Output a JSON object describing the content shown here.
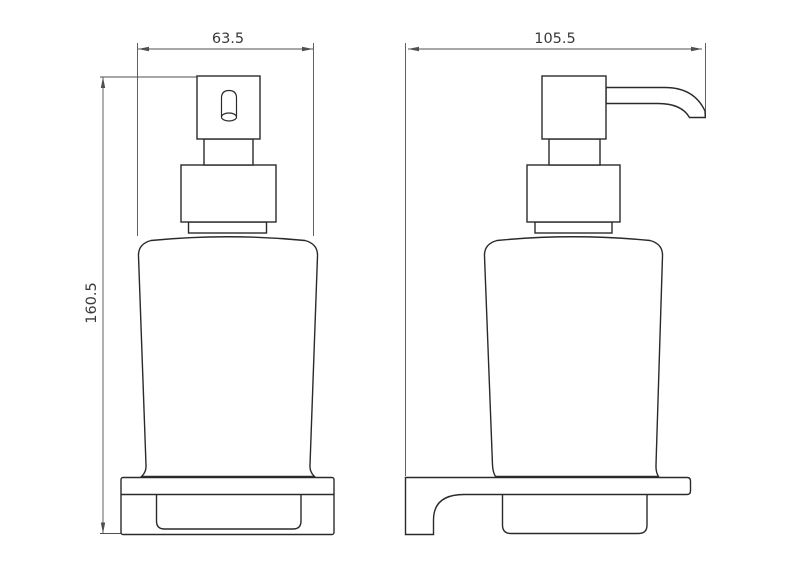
{
  "drawing": {
    "type": "technical-dimension-drawing",
    "subject": "wall-mounted soap dispenser, front and side views",
    "dimensions": {
      "front_width": "63.5",
      "overall_height": "160.5",
      "side_depth": "105.5"
    },
    "colors": {
      "background": "#ffffff",
      "object_line": "#2a2a2a",
      "dimension_line": "#4f4f4f",
      "label_text": "#3a3a3a"
    }
  }
}
